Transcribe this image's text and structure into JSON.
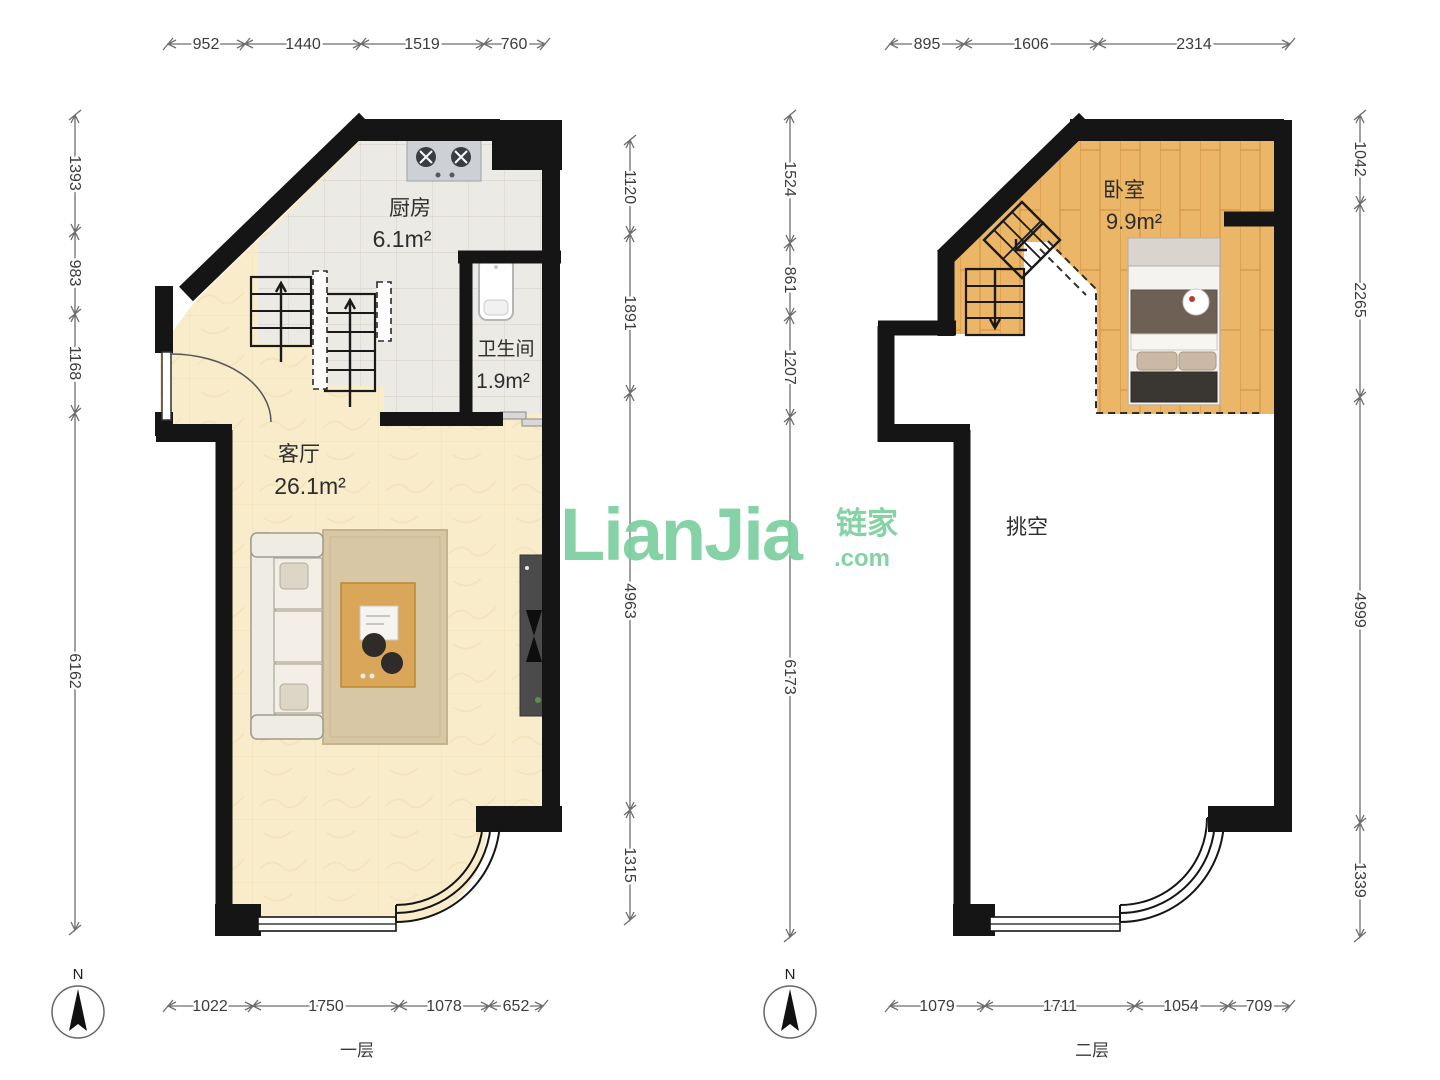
{
  "watermark": {
    "latin": "LianJia",
    "cjk": "链家",
    "tld": ".com",
    "color": "#7bcfa0"
  },
  "plans": [
    {
      "floor_label": "一层",
      "compass": "N",
      "rooms": {
        "kitchen": {
          "name": "厨房",
          "area": "6.1m²"
        },
        "bathroom": {
          "name": "卫生间",
          "area": "1.9m²"
        },
        "living": {
          "name": "客厅",
          "area": "26.1m²"
        }
      },
      "dims": {
        "top": [
          "952",
          "1440",
          "1519",
          "760"
        ],
        "left": [
          "1393",
          "983",
          "1168",
          "6162"
        ],
        "right": [
          "1120",
          "1891",
          "4963",
          "1315"
        ],
        "bottom": [
          "1022",
          "1750",
          "1078",
          "652"
        ]
      }
    },
    {
      "floor_label": "二层",
      "compass": "N",
      "rooms": {
        "bedroom": {
          "name": "卧室",
          "area": "9.9m²"
        },
        "void": {
          "name": "挑空"
        }
      },
      "dims": {
        "top": [
          "895",
          "1606",
          "2314"
        ],
        "left": [
          "1524",
          "861",
          "1207",
          "6173"
        ],
        "right": [
          "1042",
          "2265",
          "4999",
          "1339"
        ],
        "bottom": [
          "1079",
          "1711",
          "1054",
          "709"
        ]
      }
    }
  ]
}
